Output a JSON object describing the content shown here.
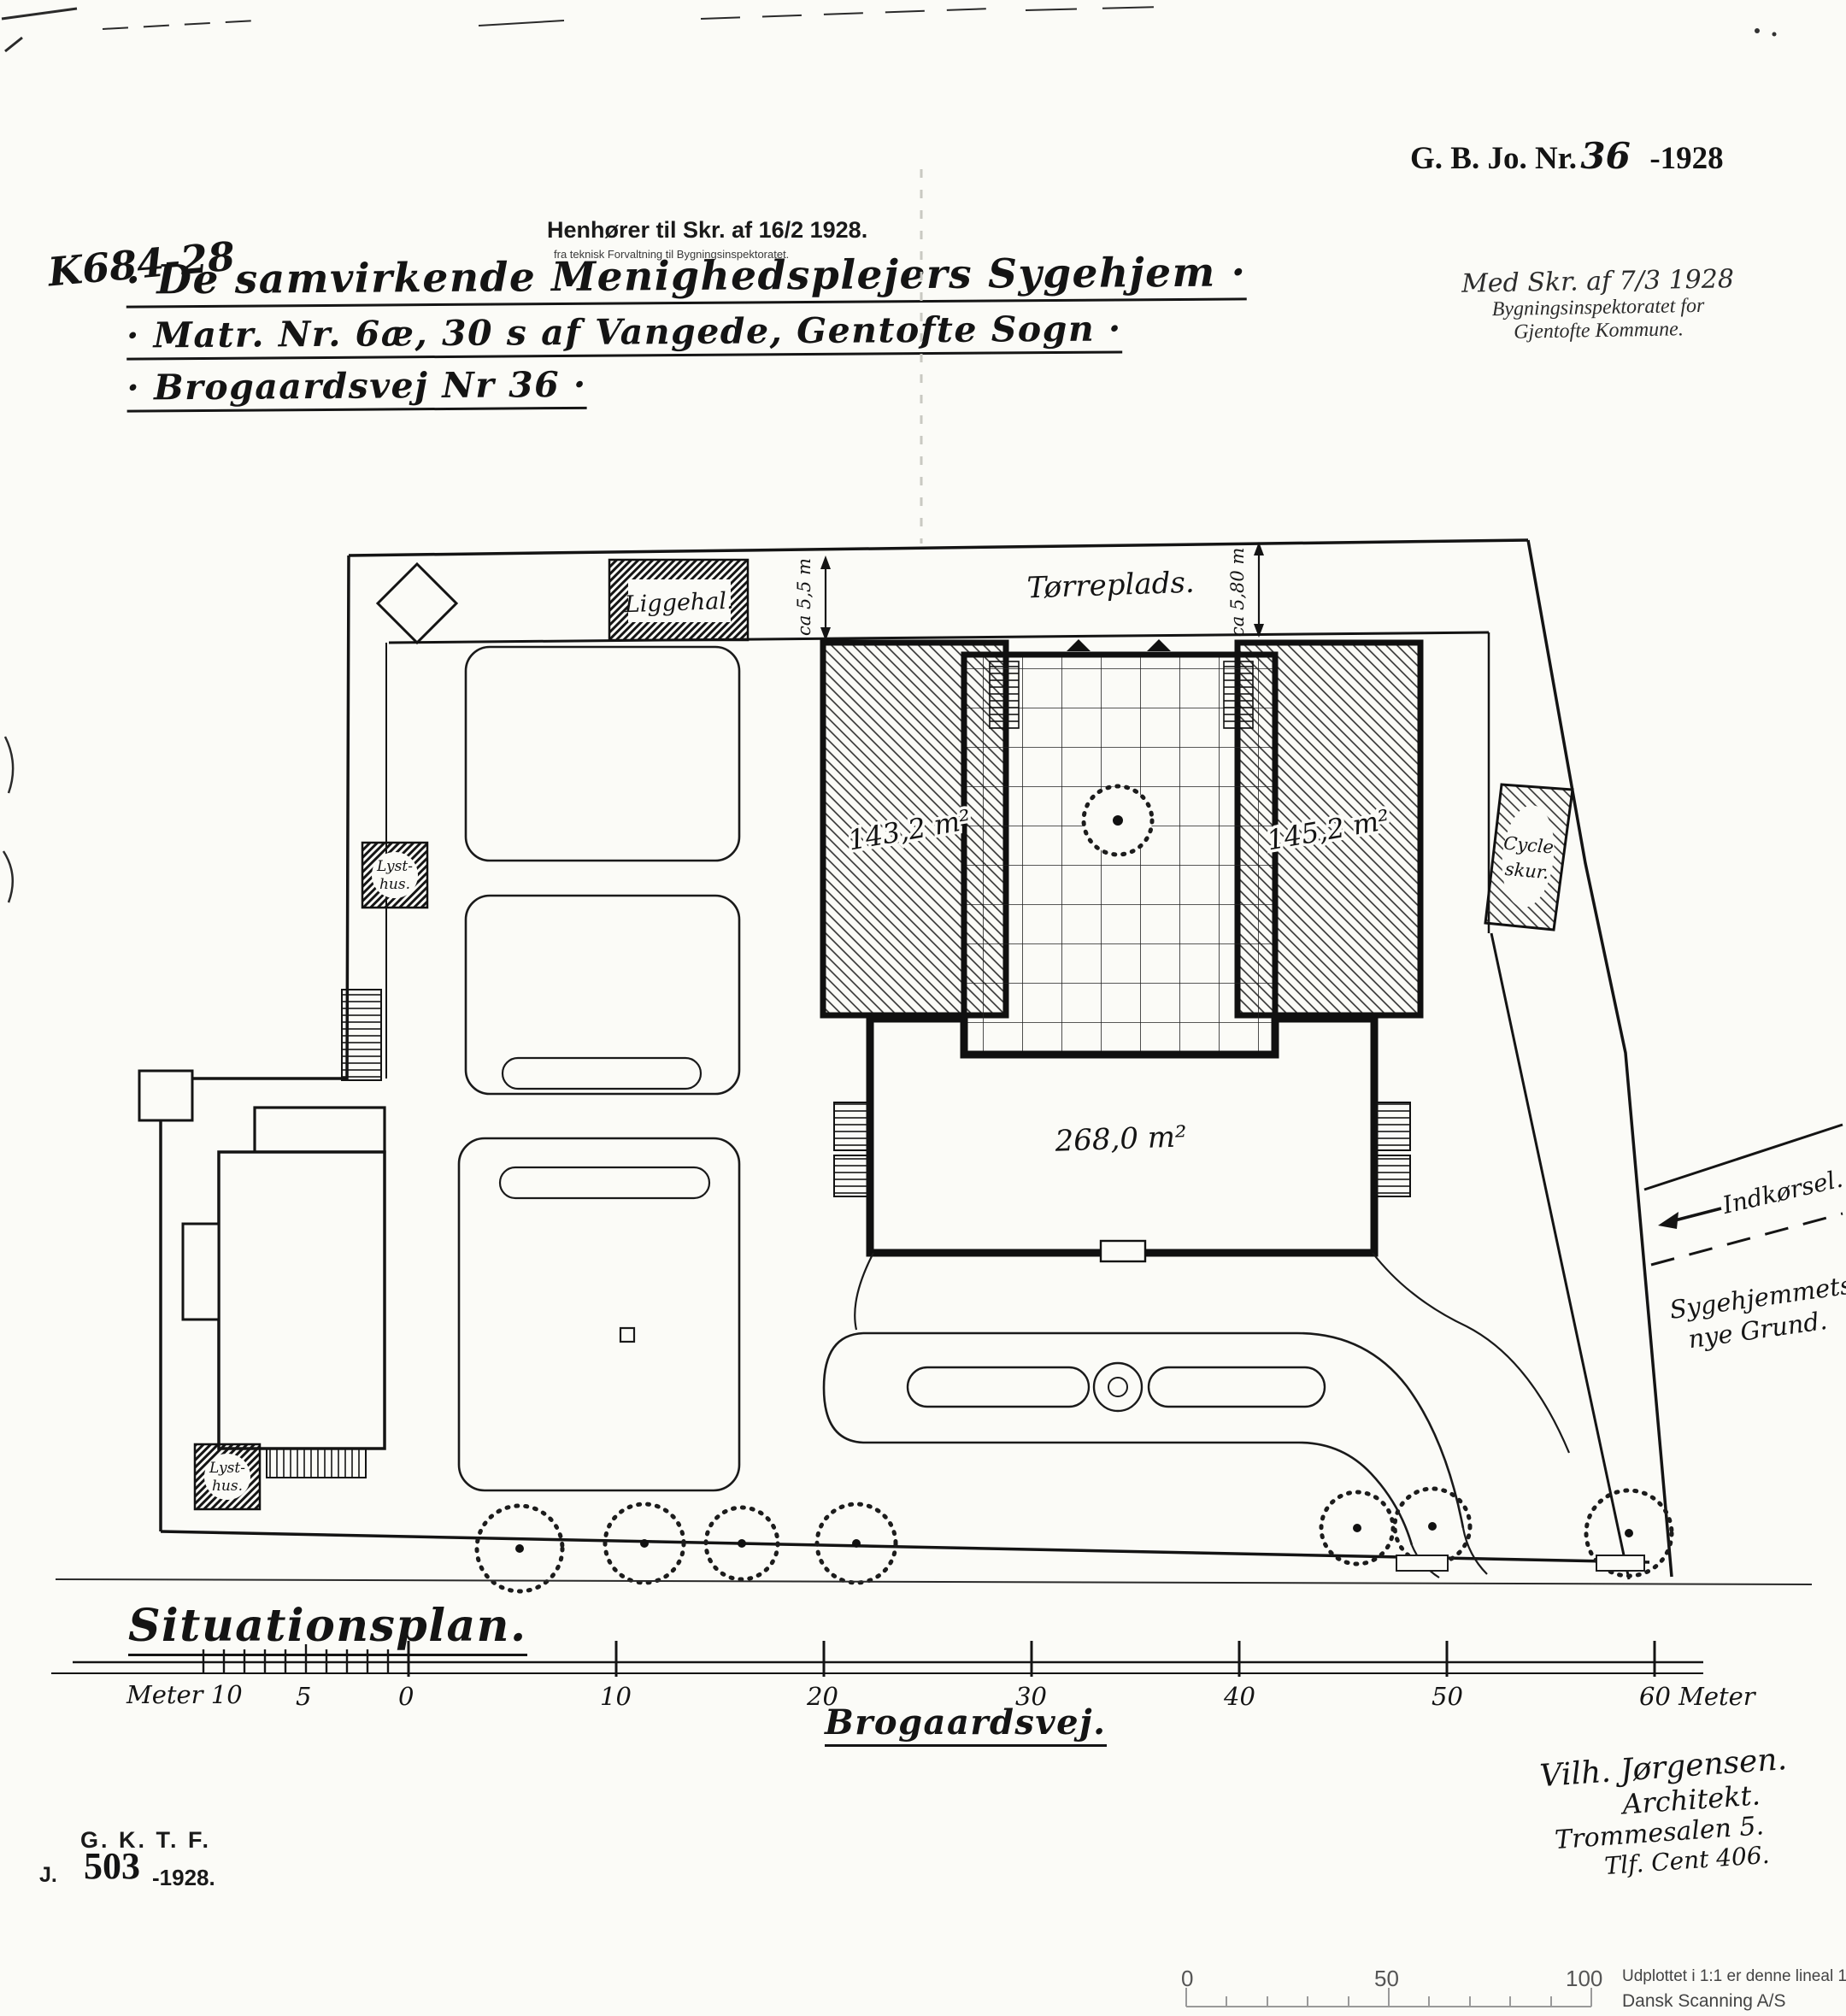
{
  "document": {
    "ref_code": "K684-28",
    "received": {
      "line1": "Henhører til Skr. af 16/2 1928.",
      "line2": "fra teknisk Forvaltning til Bygningsinspektoratet."
    },
    "journal": {
      "prefix": "G. B. Jo. Nr.",
      "number": "36",
      "year": "-1928"
    },
    "stamp": {
      "line1": "Med Skr. af 7/3 1928",
      "line2": "Bygningsinspektoratet for",
      "line3": "Gjentofte Kommune."
    },
    "title": {
      "line1": "· De samvirkende Menighedsplejers Sygehjem ·",
      "line2": "· Matr. Nr. 6æ, 30 s af Vangede, Gentofte Sogn ·",
      "line3": "· Brogaardsvej Nr 36 ·"
    }
  },
  "plan": {
    "labels": {
      "liggehal": "Liggehal.",
      "toerreplads": "Tørreplads.",
      "dim_left": "ca 5,5 m",
      "dim_right": "ca 5,80 m",
      "area_left_wing": "143,2 m²",
      "area_right_wing": "145,2 m²",
      "area_main_block": "268,0 m²",
      "lysthus_top_a": "Lyst-",
      "lysthus_top_b": "hus.",
      "lysthus_bottom_a": "Lyst-",
      "lysthus_bottom_b": "hus.",
      "cykelskur_a": "Cycle",
      "cykelskur_b": "skur.",
      "indkoersel": "Indkørsel.",
      "new_ground_a": "Sygehjemmets",
      "new_ground_b": "nye Grund."
    }
  },
  "footer": {
    "plan_type": "Situationsplan.",
    "street_name": "Brogaardsvej.",
    "scale_labels": [
      "Meter 10",
      "5",
      "0",
      "10",
      "20",
      "30",
      "40",
      "50",
      "60 Meter"
    ],
    "architect": {
      "line1": "Vilh. Jørgensen.",
      "line2": "Architekt.",
      "line3": "Trommesalen 5.",
      "line4": "Tlf. Cent 406."
    },
    "archive": {
      "gktf": "G. K. T. F.",
      "j": "J.",
      "number": "503",
      "year": "-1928."
    }
  },
  "scan_ruler": {
    "tick0": "0",
    "tick50": "50",
    "tick100": "100",
    "note": "Udplottet i 1:1 er denne lineal 100 mm.",
    "credit": "Dansk Scanning A/S"
  }
}
